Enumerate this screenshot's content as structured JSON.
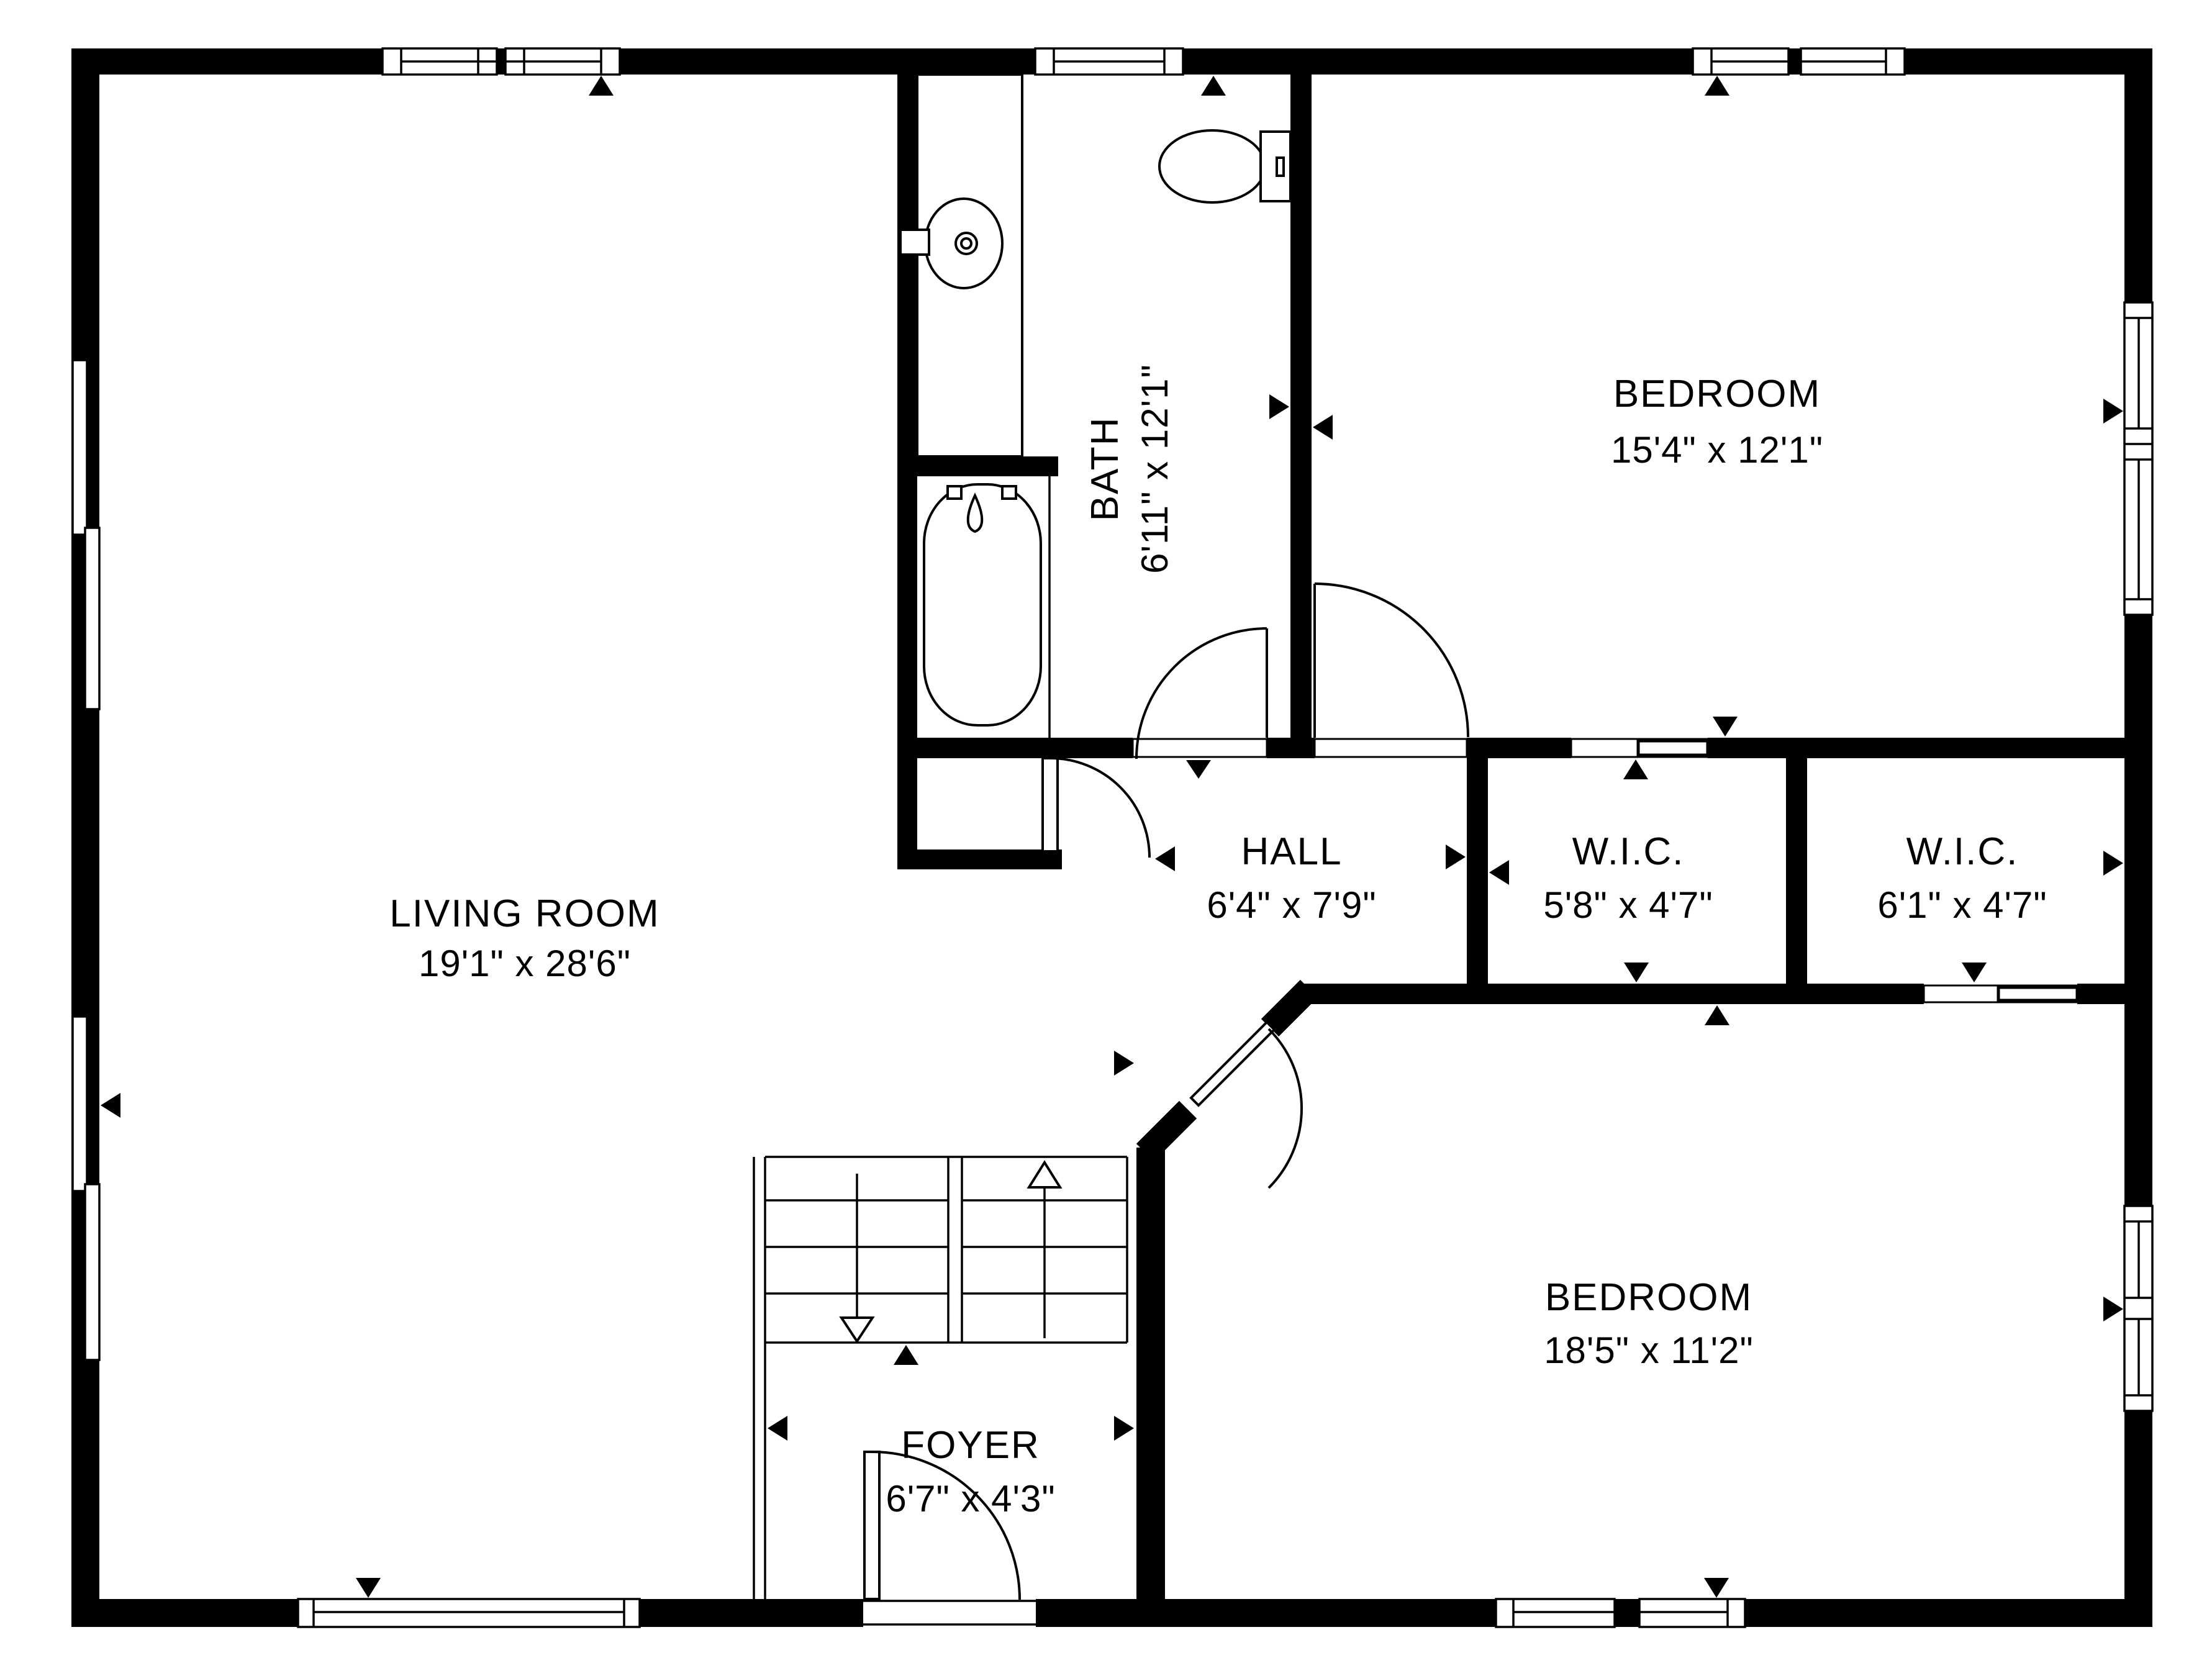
{
  "title": "Floor plan",
  "colors": {
    "wall": "#000000",
    "background": "#ffffff",
    "line": "#000000"
  },
  "rooms": {
    "living_room": {
      "name": "LIVING ROOM",
      "dims": "19'1\" x 28'6\""
    },
    "bath": {
      "name": "BATH",
      "dims": "6'11\" x 12'1\""
    },
    "bedroom_top": {
      "name": "BEDROOM",
      "dims": "15'4\" x 12'1\""
    },
    "hall": {
      "name": "HALL",
      "dims": "6'4\" x 7'9\""
    },
    "wic_left": {
      "name": "W.I.C.",
      "dims": "5'8\" x 4'7\""
    },
    "wic_right": {
      "name": "W.I.C.",
      "dims": "6'1\" x 4'7\""
    },
    "bedroom_bottom": {
      "name": "BEDROOM",
      "dims": "18'5\" x 11'2\""
    },
    "foyer": {
      "name": "FOYER",
      "dims": "6'7\" x 4'3\""
    }
  }
}
